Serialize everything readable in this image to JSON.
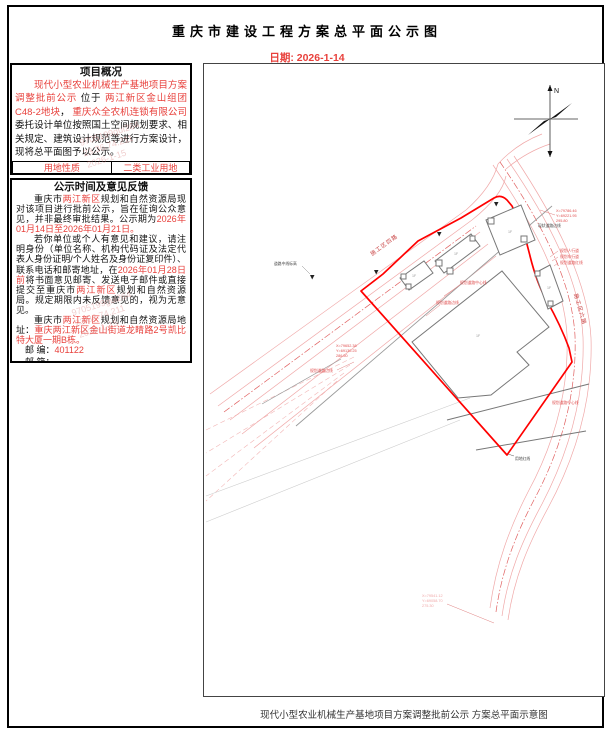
{
  "page": {
    "title": "重庆市建设工程方案总平面公示图",
    "date": "日期: 2026-1-14"
  },
  "overview": {
    "header": "项目概况",
    "p1": {
      "s1": "现代小型农业机械生产基地项目方案调整批前公示",
      "s2": " 位于 ",
      "s3": "两江新区金山组团C48-2地块",
      "s4": "， ",
      "s5": "重庆众全农机连锁有限公司",
      "s6": "委托设计单位按照国土空间规划要求、相关规定、建筑设计规范等进行方案设计，现将总平面图予以公示。"
    },
    "table": {
      "rows": [
        {
          "label": "用地性质",
          "value": "二类工业用地"
        },
        {
          "label": "用地面积",
          "value": "32281平方米"
        },
        {
          "label": "规划容积率（总计容建筑面积）",
          "value": "0.9"
        }
      ]
    }
  },
  "feedback": {
    "header": "公示时间及意见反馈",
    "p1": {
      "s1": "重庆市",
      "s2": "两江新区",
      "s3": "规划和自然资源局现对该项目进行批前公示，旨在征询公众意见，并非最终审批结果。公示期为",
      "s4": "2026年01月14日至2026年01月21日。"
    },
    "p2": {
      "s1": "若你单位或个人有意见和建议，请注明身份（单位名称、机构代码证及法定代表人身份证明/个人姓名及身份证复印件）、联系电话和邮寄地址，在",
      "s2": "2026年01月28日前",
      "s3": "将书面意见邮寄、发送电子邮件或直接提交至重庆市",
      "s4": "两江新区",
      "s5": "规划和自然资源局。规定期限内未反馈意见的，视为无意见。"
    },
    "p3": {
      "s1": "重庆市",
      "s2": "两江新区",
      "s3": "规划和自然资源局地址：",
      "s4": "重庆两江新区金山街道龙睛路2号凯比特大厦一期B栋。"
    },
    "contact": {
      "post_label": "邮 编：",
      "post_value": "401122",
      "mail_label": "邮 箱：",
      "fax_label": "传 真：",
      "person_label": "联系人：",
      "person_value": "梅宇",
      "phone_label": "，联系电话：",
      "phone_value": "67309956"
    }
  },
  "watermark": {
    "l1": "9705199gui264",
    "l2": "23.36.74.211",
    "l3": "2026-1-15"
  },
  "plan": {
    "caption": "现代小型农业机械生产基地项目方案调整批前公示 方案总平面示意图",
    "north": "N",
    "roads": {
      "r1": "施工区四路",
      "r2": "施工区六路"
    },
    "coords": {
      "tr1": "X=79786.46",
      "tr2": "Y=69221.95",
      "tr3": "295.80",
      "ml1": "X=79652.38",
      "ml2": "Y=69130.25",
      "ml3": "286.50",
      "b1": "X=79541.12",
      "b2": "Y=69058.70",
      "b3": "275.30"
    },
    "labels": {
      "road_elev": "道路中线标高",
      "exist_edge": "现状道路边线",
      "ped": "规划人行道",
      "veh": "规划车行道",
      "redline": "规划道路红线",
      "centerline": "规划道路中心线",
      "edge": "规划道路边线",
      "site_redline": "用地红线",
      "floor": "1F"
    }
  }
}
